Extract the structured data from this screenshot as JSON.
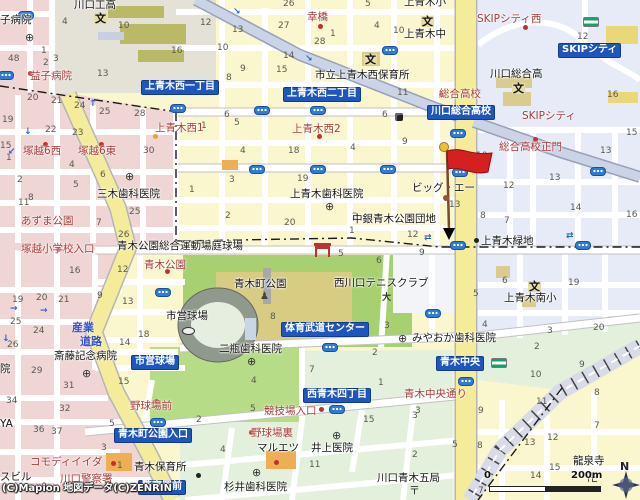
{
  "map": {
    "attribution": "(C)Mapion 地図データ(C)ZENRIN",
    "scale": {
      "zero": "0",
      "distance": "200m"
    },
    "compass": "N",
    "marker": {
      "kind": "destination-flag",
      "color": "#D42020"
    },
    "colors": {
      "chip_blue": "#1E56BE",
      "road_yellow": "#F5EC9B",
      "park_green": "#A7D170",
      "ballpark_green": "#B7DC88",
      "block_pink": "#EFD6D4",
      "zone_blue": "#E6EBF7",
      "zone_green": "#E3F0DB",
      "park_khaki": "#D8CB82",
      "red_label": "#A93E3E",
      "avenue_blue_gray": "#CBD4E6",
      "signal_blue": "#2E7CD6"
    },
    "chips": [
      {
        "t": "上青木西一丁目",
        "x": 141,
        "y": 80
      },
      {
        "t": "上青木西二丁目",
        "x": 283,
        "y": 87
      },
      {
        "t": "川口総合高校",
        "x": 427,
        "y": 105
      },
      {
        "t": "SKIPシティ",
        "x": 558,
        "y": 43
      },
      {
        "t": "体育武道センター",
        "x": 281,
        "y": 322
      },
      {
        "t": "市営球場",
        "x": 131,
        "y": 355
      },
      {
        "t": "青木町公園入口",
        "x": 114,
        "y": 428
      },
      {
        "t": "西青木四丁目",
        "x": 303,
        "y": 388
      },
      {
        "t": "青木中央",
        "x": 436,
        "y": 356
      },
      {
        "t": "警察署前",
        "x": 138,
        "y": 480
      }
    ],
    "red_labels": [
      {
        "t": "幸橋",
        "x": 307,
        "y": 12
      },
      {
        "t": "SKIPシティ西",
        "x": 477,
        "y": 14
      },
      {
        "t": "SKIPシティ",
        "x": 522,
        "y": 111
      },
      {
        "t": "総合高校",
        "x": 439,
        "y": 89
      },
      {
        "t": "総合高校正門",
        "x": 499,
        "y": 142
      },
      {
        "t": "上青木西1",
        "x": 155,
        "y": 123
      },
      {
        "t": "塚越6西",
        "x": 23,
        "y": 146
      },
      {
        "t": "塚越6東",
        "x": 78,
        "y": 146
      },
      {
        "t": "上青木西2",
        "x": 292,
        "y": 124
      },
      {
        "t": "あずま公園",
        "x": 21,
        "y": 216
      },
      {
        "t": "塚越小学校入口",
        "x": 21,
        "y": 244
      },
      {
        "t": "青木公園",
        "x": 144,
        "y": 260
      },
      {
        "t": "野球場前",
        "x": 130,
        "y": 401
      },
      {
        "t": "競技場入口",
        "x": 264,
        "y": 406
      },
      {
        "t": "野球場裏",
        "x": 251,
        "y": 428
      },
      {
        "t": "コモディイイダ",
        "x": 30,
        "y": 457
      },
      {
        "t": "川口警察署",
        "x": 60,
        "y": 474
      },
      {
        "t": "青木中央通り",
        "x": 404,
        "y": 389
      },
      {
        "t": "益子病院",
        "x": 30,
        "y": 71
      }
    ],
    "black_labels": [
      {
        "t": "川口工高",
        "x": 74,
        "y": 0
      },
      {
        "t": "子病院",
        "x": 0,
        "y": 15
      },
      {
        "t": "市立上青木西保育所",
        "x": 315,
        "y": 70
      },
      {
        "t": "上青木小",
        "x": 404,
        "y": -3
      },
      {
        "t": "上青木中",
        "x": 404,
        "y": 29
      },
      {
        "t": "川口総合高",
        "x": 490,
        "y": 69
      },
      {
        "t": "三木歯科医院",
        "x": 97,
        "y": 189
      },
      {
        "t": "上青木歯科医院",
        "x": 290,
        "y": 189
      },
      {
        "t": "ビッグ・エー",
        "x": 412,
        "y": 183
      },
      {
        "t": "中銀青木公園団地",
        "x": 352,
        "y": 214
      },
      {
        "t": "上青木緑地",
        "x": 481,
        "y": 236
      },
      {
        "t": "青木公園総合運動場庭球場",
        "x": 117,
        "y": 241
      },
      {
        "t": "西川口テニスクラブ",
        "x": 334,
        "y": 278
      },
      {
        "t": "青木町公園",
        "x": 234,
        "y": 279
      },
      {
        "t": "市営球場",
        "x": 166,
        "y": 311
      },
      {
        "t": "二瓶歯科医院",
        "x": 219,
        "y": 344
      },
      {
        "t": "みやおか歯科医院",
        "x": 412,
        "y": 333
      },
      {
        "t": "上青木南小",
        "x": 504,
        "y": 293
      },
      {
        "t": "マルエツ",
        "x": 257,
        "y": 443
      },
      {
        "t": "井上医院",
        "x": 311,
        "y": 443
      },
      {
        "t": "杉井歯科医院",
        "x": 224,
        "y": 482
      },
      {
        "t": "青木保育所",
        "x": 134,
        "y": 462
      },
      {
        "t": "川口青木五局",
        "x": 377,
        "y": 473
      },
      {
        "t": "龍泉寺",
        "x": 573,
        "y": 456
      },
      {
        "t": "斎藤記念病院",
        "x": 54,
        "y": 351
      },
      {
        "t": "院",
        "x": 0,
        "y": 364
      },
      {
        "t": "YA",
        "x": 0,
        "y": 419
      },
      {
        "t": "スビル",
        "x": 0,
        "y": 472
      }
    ],
    "road_names": [
      {
        "t": "産業",
        "x": 72,
        "y": 322
      },
      {
        "t": "道路",
        "x": 80,
        "y": 336
      }
    ],
    "numbers": [
      {
        "t": "4",
        "x": 62,
        "y": 18
      },
      {
        "t": "10",
        "x": 118,
        "y": 22
      },
      {
        "t": "12",
        "x": 200,
        "y": 19
      },
      {
        "t": "16",
        "x": 171,
        "y": 47
      },
      {
        "t": "48",
        "x": 8,
        "y": 55
      },
      {
        "t": "1",
        "x": 41,
        "y": 47
      },
      {
        "t": "2",
        "x": 43,
        "y": 59
      },
      {
        "t": "3",
        "x": 53,
        "y": 55
      },
      {
        "t": "13",
        "x": 97,
        "y": 70
      },
      {
        "t": "20",
        "x": 27,
        "y": 94
      },
      {
        "t": "21",
        "x": 51,
        "y": 97
      },
      {
        "t": "24",
        "x": 74,
        "y": 102
      },
      {
        "t": "25",
        "x": 99,
        "y": 108
      },
      {
        "t": "28",
        "x": 134,
        "y": 110
      },
      {
        "t": "22",
        "x": 45,
        "y": 126
      },
      {
        "t": "23",
        "x": 72,
        "y": 129
      },
      {
        "t": "26",
        "x": 283,
        "y": 0
      },
      {
        "t": "5",
        "x": 365,
        "y": 0
      },
      {
        "t": "13",
        "x": 232,
        "y": 26
      },
      {
        "t": "27",
        "x": 278,
        "y": 22
      },
      {
        "t": "1",
        "x": 330,
        "y": 30
      },
      {
        "t": "4",
        "x": 374,
        "y": 22
      },
      {
        "t": "10",
        "x": 393,
        "y": 27
      },
      {
        "t": "28",
        "x": 314,
        "y": 38
      },
      {
        "t": "10",
        "x": 217,
        "y": 44
      },
      {
        "t": "14",
        "x": 283,
        "y": 52
      },
      {
        "t": "15",
        "x": 276,
        "y": 66
      },
      {
        "t": "9",
        "x": 240,
        "y": 65
      },
      {
        "t": "8",
        "x": 226,
        "y": 74
      },
      {
        "t": "6",
        "x": 224,
        "y": 111
      },
      {
        "t": "11",
        "x": 397,
        "y": 89
      },
      {
        "t": "6",
        "x": 382,
        "y": 111
      },
      {
        "t": "12",
        "x": 577,
        "y": 33
      },
      {
        "t": "16",
        "x": 607,
        "y": 91
      },
      {
        "t": "15",
        "x": 626,
        "y": 129
      },
      {
        "t": "19",
        "x": 2,
        "y": 116
      },
      {
        "t": "15",
        "x": 0,
        "y": 142
      },
      {
        "t": "1",
        "x": 6,
        "y": 154
      },
      {
        "t": "2",
        "x": 17,
        "y": 176
      },
      {
        "t": "4",
        "x": 69,
        "y": 161
      },
      {
        "t": "5",
        "x": 73,
        "y": 181
      },
      {
        "t": "6",
        "x": 100,
        "y": 171
      },
      {
        "t": "8",
        "x": 28,
        "y": 194
      },
      {
        "t": "11",
        "x": 18,
        "y": 199
      },
      {
        "t": "30",
        "x": 143,
        "y": 147
      },
      {
        "t": "25",
        "x": 129,
        "y": 208
      },
      {
        "t": "26",
        "x": 118,
        "y": 231
      },
      {
        "t": "7",
        "x": 96,
        "y": 219
      },
      {
        "t": "1",
        "x": 189,
        "y": 186
      },
      {
        "t": "1",
        "x": 201,
        "y": 122
      },
      {
        "t": "5",
        "x": 234,
        "y": 119
      },
      {
        "t": "4",
        "x": 240,
        "y": 147
      },
      {
        "t": "18",
        "x": 288,
        "y": 147
      },
      {
        "t": "4",
        "x": 350,
        "y": 144
      },
      {
        "t": "9",
        "x": 402,
        "y": 138
      },
      {
        "t": "3",
        "x": 229,
        "y": 176
      },
      {
        "t": "19",
        "x": 297,
        "y": 175
      },
      {
        "t": "2",
        "x": 225,
        "y": 212
      },
      {
        "t": "20",
        "x": 284,
        "y": 219
      },
      {
        "t": "2",
        "x": 352,
        "y": 213
      },
      {
        "t": "1",
        "x": 349,
        "y": 227
      },
      {
        "t": "12",
        "x": 407,
        "y": 231
      },
      {
        "t": "10",
        "x": 476,
        "y": 152
      },
      {
        "t": "13",
        "x": 600,
        "y": 147
      },
      {
        "t": "12",
        "x": 503,
        "y": 182
      },
      {
        "t": "13",
        "x": 549,
        "y": 174
      },
      {
        "t": "14",
        "x": 570,
        "y": 204
      },
      {
        "t": "13",
        "x": 449,
        "y": 201
      },
      {
        "t": "8",
        "x": 480,
        "y": 212
      },
      {
        "t": "7",
        "x": 504,
        "y": 217
      },
      {
        "t": "16",
        "x": 626,
        "y": 211
      },
      {
        "t": "16",
        "x": 69,
        "y": 267
      },
      {
        "t": "12",
        "x": 117,
        "y": 266
      },
      {
        "t": "19",
        "x": 12,
        "y": 296
      },
      {
        "t": "20",
        "x": 36,
        "y": 294
      },
      {
        "t": "21",
        "x": 58,
        "y": 296
      },
      {
        "t": "9",
        "x": 97,
        "y": 292
      },
      {
        "t": "13",
        "x": 122,
        "y": 298
      },
      {
        "t": "25",
        "x": 10,
        "y": 318
      },
      {
        "t": "24",
        "x": 33,
        "y": 327
      },
      {
        "t": "26",
        "x": 7,
        "y": 341
      },
      {
        "t": "18",
        "x": 138,
        "y": 331
      },
      {
        "t": "14",
        "x": 119,
        "y": 339
      },
      {
        "t": "29",
        "x": 31,
        "y": 367
      },
      {
        "t": "31",
        "x": 63,
        "y": 382
      },
      {
        "t": "34",
        "x": 6,
        "y": 397
      },
      {
        "t": "32",
        "x": 59,
        "y": 405
      },
      {
        "t": "36",
        "x": 33,
        "y": 426
      },
      {
        "t": "37",
        "x": 51,
        "y": 428
      },
      {
        "t": "15",
        "x": 118,
        "y": 378
      },
      {
        "t": "3",
        "x": 101,
        "y": 444
      },
      {
        "t": "5",
        "x": 109,
        "y": 420
      },
      {
        "t": "1",
        "x": 117,
        "y": 462
      },
      {
        "t": "4",
        "x": 251,
        "y": 377
      },
      {
        "t": "1",
        "x": 378,
        "y": 379
      },
      {
        "t": "5",
        "x": 250,
        "y": 405
      },
      {
        "t": "2",
        "x": 196,
        "y": 416
      },
      {
        "t": "15",
        "x": 363,
        "y": 416
      },
      {
        "t": "4",
        "x": 220,
        "y": 446
      },
      {
        "t": "11",
        "x": 309,
        "y": 461
      },
      {
        "t": "3",
        "x": 412,
        "y": 412
      },
      {
        "t": "2",
        "x": 412,
        "y": 451
      },
      {
        "t": "6",
        "x": 502,
        "y": 277
      },
      {
        "t": "19",
        "x": 568,
        "y": 279
      },
      {
        "t": "5",
        "x": 473,
        "y": 290
      },
      {
        "t": "4",
        "x": 482,
        "y": 321
      },
      {
        "t": "3",
        "x": 547,
        "y": 327
      },
      {
        "t": "20",
        "x": 593,
        "y": 324
      },
      {
        "t": "2",
        "x": 534,
        "y": 343
      },
      {
        "t": "9",
        "x": 579,
        "y": 361
      },
      {
        "t": "10",
        "x": 530,
        "y": 371
      },
      {
        "t": "5",
        "x": 338,
        "y": 250
      },
      {
        "t": "6",
        "x": 376,
        "y": 257
      },
      {
        "t": "9",
        "x": 419,
        "y": 249
      },
      {
        "t": "3",
        "x": 384,
        "y": 322
      },
      {
        "t": "2",
        "x": 372,
        "y": 349
      },
      {
        "t": "7",
        "x": 309,
        "y": 366
      },
      {
        "t": "8",
        "x": 270,
        "y": 313
      },
      {
        "t": "9",
        "x": 478,
        "y": 407
      },
      {
        "t": "11",
        "x": 536,
        "y": 398
      },
      {
        "t": "8",
        "x": 594,
        "y": 389
      },
      {
        "t": "3",
        "x": 415,
        "y": 407
      },
      {
        "t": "5",
        "x": 452,
        "y": 441
      },
      {
        "t": "8",
        "x": 477,
        "y": 442
      },
      {
        "t": "13",
        "x": 524,
        "y": 439
      },
      {
        "t": "12",
        "x": 547,
        "y": 434
      },
      {
        "t": "7",
        "x": 594,
        "y": 422
      },
      {
        "t": "15",
        "x": 549,
        "y": 464
      },
      {
        "t": "14",
        "x": 530,
        "y": 472
      },
      {
        "t": "7",
        "x": 478,
        "y": 487
      }
    ],
    "signals": [
      {
        "x": 26,
        "y": 15
      },
      {
        "x": 6,
        "y": 75
      },
      {
        "x": 178,
        "y": 108
      },
      {
        "x": 262,
        "y": 110
      },
      {
        "x": 318,
        "y": 110
      },
      {
        "x": 390,
        "y": 50
      },
      {
        "x": 257,
        "y": 169
      },
      {
        "x": 318,
        "y": 169
      },
      {
        "x": 388,
        "y": 169
      },
      {
        "x": 458,
        "y": 133
      },
      {
        "x": 460,
        "y": 172
      },
      {
        "x": 598,
        "y": 171
      },
      {
        "x": 163,
        "y": 292
      },
      {
        "x": 458,
        "y": 245
      },
      {
        "x": 583,
        "y": 245
      },
      {
        "x": 330,
        "y": 347
      },
      {
        "x": 433,
        "y": 313
      },
      {
        "x": 466,
        "y": 381
      },
      {
        "x": 337,
        "y": 409
      },
      {
        "x": 158,
        "y": 422
      }
    ],
    "arrows": [
      {
        "t": "↘",
        "x": 233,
        "y": 8
      },
      {
        "t": "↘",
        "x": 305,
        "y": 55
      },
      {
        "t": "↑",
        "x": 89,
        "y": 100
      },
      {
        "t": "↓",
        "x": 24,
        "y": 128
      },
      {
        "t": "↙",
        "x": 8,
        "y": 148
      },
      {
        "t": "→",
        "x": 10,
        "y": 305
      },
      {
        "t": "→",
        "x": 40,
        "y": 307
      },
      {
        "t": "↓",
        "x": 2,
        "y": 335
      },
      {
        "t": "⇄",
        "x": 424,
        "y": 234
      },
      {
        "t": "⇄",
        "x": 566,
        "y": 232
      }
    ],
    "dots": [
      {
        "x": 320,
        "y": 26,
        "c": "#C03030"
      },
      {
        "x": 525,
        "y": 27,
        "c": "#C03030"
      },
      {
        "x": 535,
        "y": 139,
        "c": "#C03030"
      },
      {
        "x": 30,
        "y": 73,
        "c": "#C03030"
      },
      {
        "x": 45,
        "y": 144,
        "c": "#C03030"
      },
      {
        "x": 101,
        "y": 144,
        "c": "#C03030"
      },
      {
        "x": 319,
        "y": 136,
        "c": "#C03030"
      },
      {
        "x": 58,
        "y": 249,
        "c": "#C03030"
      },
      {
        "x": 167,
        "y": 271,
        "c": "#C03030"
      },
      {
        "x": 441,
        "y": 94,
        "c": "#C03030"
      },
      {
        "x": 156,
        "y": 401,
        "c": "#C03030"
      },
      {
        "x": 251,
        "y": 432,
        "c": "#C03030"
      },
      {
        "x": 321,
        "y": 409,
        "c": "#C03030"
      },
      {
        "x": 276,
        "y": 462,
        "c": "#C03030"
      },
      {
        "x": 113,
        "y": 463,
        "c": "#C03030"
      },
      {
        "x": 476,
        "y": 240,
        "c": "#222222"
      },
      {
        "x": 198,
        "y": 475,
        "c": "#222222"
      },
      {
        "x": 155,
        "y": 136,
        "c": "#E8A23C"
      }
    ],
    "icons": [
      {
        "k": "school",
        "g": "文",
        "x": 94,
        "y": 13
      },
      {
        "k": "school",
        "g": "文",
        "x": 421,
        "y": 16
      },
      {
        "k": "school",
        "g": "文",
        "x": 364,
        "y": 54
      },
      {
        "k": "school",
        "g": "文",
        "x": 512,
        "y": 83
      },
      {
        "k": "school",
        "g": "文",
        "x": 528,
        "y": 281
      },
      {
        "k": "hospital",
        "g": "⊕",
        "x": 25,
        "y": 32
      },
      {
        "k": "hospital",
        "g": "⊕",
        "x": 125,
        "y": 171
      },
      {
        "k": "hospital",
        "g": "⊕",
        "x": 325,
        "y": 201
      },
      {
        "k": "hospital",
        "g": "⊕",
        "x": 82,
        "y": 368
      },
      {
        "k": "hospital",
        "g": "⊕",
        "x": 247,
        "y": 356
      },
      {
        "k": "hospital",
        "g": "⊕",
        "x": 398,
        "y": 333
      },
      {
        "k": "hospital",
        "g": "⊕",
        "x": 332,
        "y": 430
      },
      {
        "k": "hospital",
        "g": "⊕",
        "x": 252,
        "y": 467
      },
      {
        "k": "post",
        "g": "〒",
        "x": 409,
        "y": 485
      },
      {
        "k": "temple",
        "g": "卍",
        "x": 587,
        "y": 472
      },
      {
        "k": "monument",
        "g": "♟",
        "x": 260,
        "y": 292
      },
      {
        "k": "tennis",
        "g": "大",
        "x": 382,
        "y": 294
      },
      {
        "k": "store",
        "g": "",
        "x": 583,
        "y": 17
      },
      {
        "k": "store",
        "g": "",
        "x": 491,
        "y": 358
      },
      {
        "k": "poi",
        "g": "",
        "x": 395,
        "y": 113
      },
      {
        "k": "torii",
        "g": "",
        "x": 315,
        "y": 246
      },
      {
        "k": "stadium",
        "g": "",
        "x": 182,
        "y": 327
      }
    ]
  }
}
